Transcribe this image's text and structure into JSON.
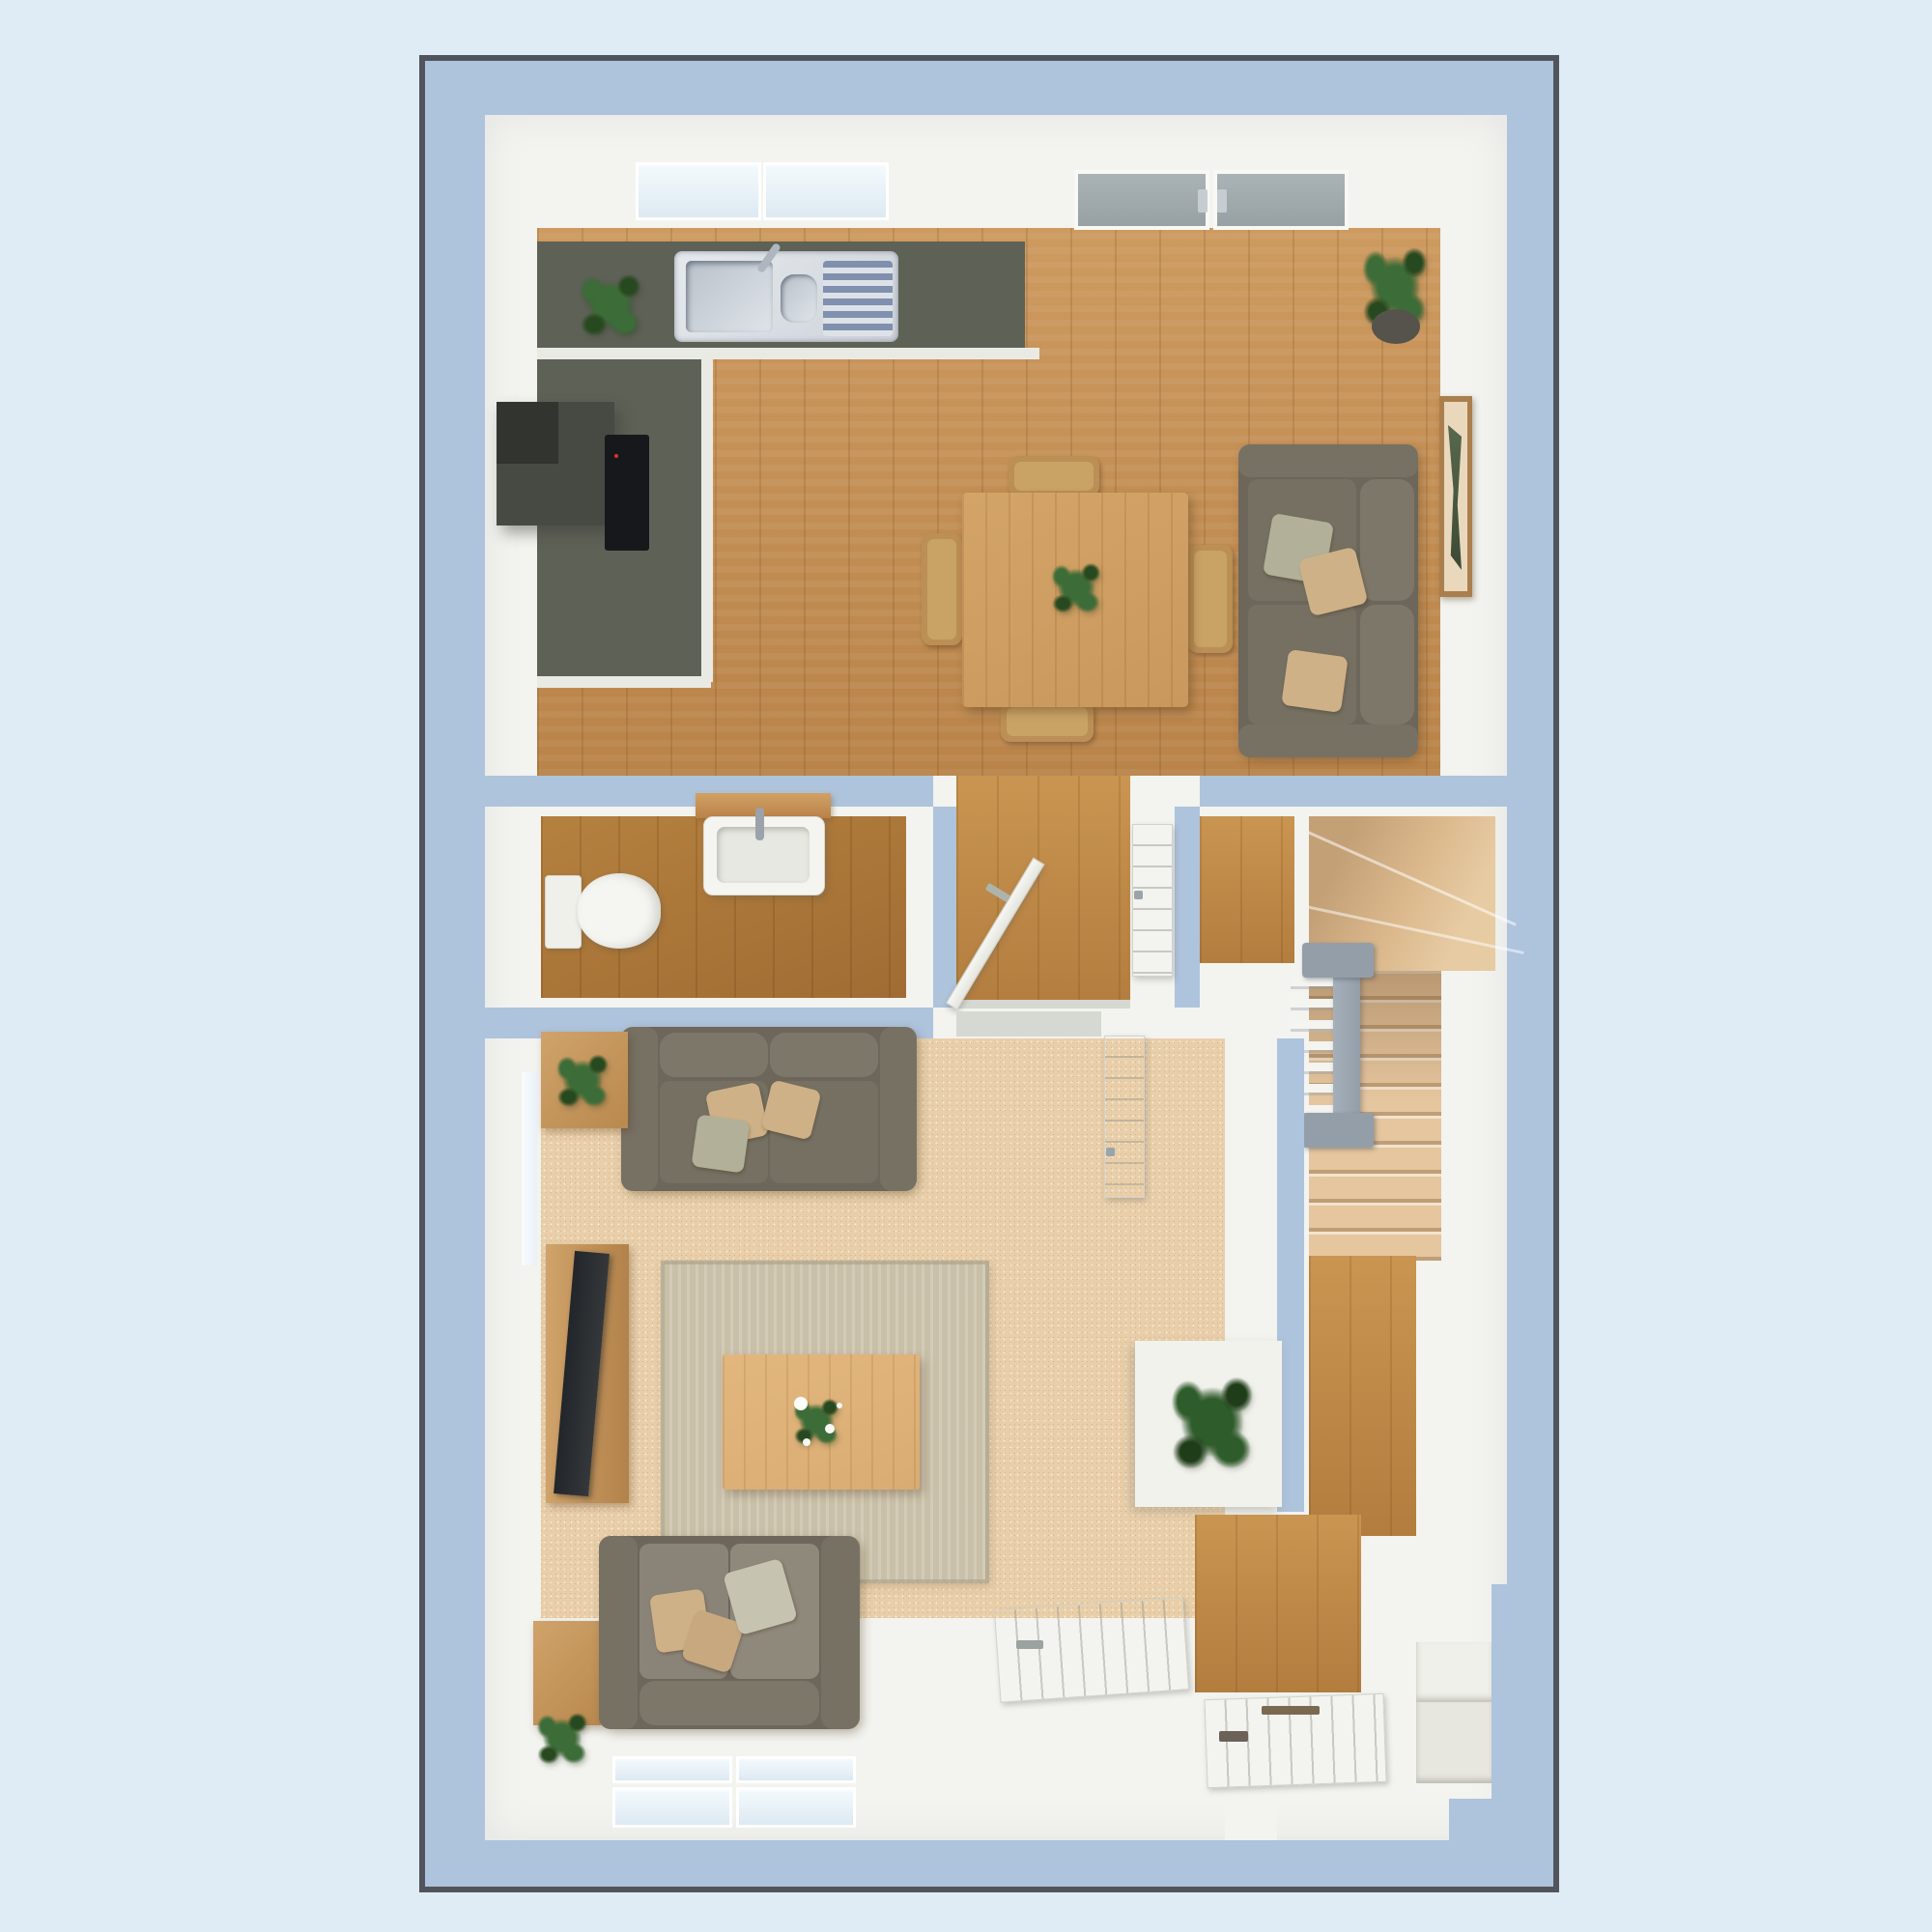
{
  "scene": {
    "kind": "3d-rendered-floor-plan",
    "view": "top-down dollhouse view, single storey",
    "no_visible_text": true
  },
  "palette": {
    "bg": "#dfecf5",
    "frame_border": "#51555b",
    "wall": "#aec3dc",
    "interior": "#f3f3ef",
    "counter": "#5e6156",
    "counter_edge": "#eaeae4",
    "steel": "#ced3d9",
    "drainer_stripe": "#8090ae",
    "hob": "#17181b",
    "hood": "#474a43",
    "sofa": "#6c665b",
    "sofa_arm": "#777164",
    "sofa_seat": "#757062",
    "sofa_back": "#7d776a",
    "pillow_tan": "#cfb187",
    "pillow_sage": "#b2b098",
    "table_wood": "#c9985c",
    "chair_wood": "#bb8f55",
    "carpet": "#e9cfa9",
    "stairs_carpet": "#e5c69e",
    "rug": "#c9c0a9",
    "coffee": "#d9ac73",
    "tvunit": "#c49960",
    "tv": "#34383b",
    "rail": "#949ea8",
    "door": "#f1f2ed",
    "plant": "#3c6d38",
    "plant_dark": "#27491f",
    "pframe": "#aa7f4d",
    "pmat": "#ead8bd",
    "part": "#57684c",
    "glass": "#dde9f2",
    "glass_gray": "#97a1a4",
    "threshold": "#d6d8d2"
  },
  "rooms": {
    "kitchen_dining": {
      "name": "kitchen-dining-room",
      "floor": "oak wood",
      "items": [
        "l-shaped-counter",
        "double-sink-with-drainer",
        "tap",
        "counter-plant",
        "extractor-hood",
        "induction-hob",
        "kitchen-window",
        "french-doors",
        "dining-table",
        "table-centre-plant",
        "dining-chairs",
        "two-seat-sofa",
        "scatter-pillows",
        "wall-art",
        "corner-potted-fern"
      ],
      "dining_chair_count": 4
    },
    "wc": {
      "name": "cloakroom-wc",
      "floor": "oak wood",
      "items": [
        "toilet",
        "wash-basin",
        "basin-shelf",
        "tap"
      ]
    },
    "hallway_passage": {
      "name": "inner-hallway",
      "floor": "oak wood",
      "items": [
        "open-door",
        "wall-radiator",
        "threshold"
      ]
    },
    "stair_hall": {
      "name": "staircase-hall",
      "floor": "carpet stairs over wood landing",
      "items": [
        "winder-treads",
        "straight-flight",
        "balustrade",
        "newel-posts",
        "spindles"
      ]
    },
    "living_room": {
      "name": "living-room",
      "floor": "beige carpet",
      "items": [
        "sofa-top",
        "sofa-bottom",
        "scatter-pillows",
        "area-rug",
        "coffee-table",
        "flower-centrepiece",
        "tv-unit",
        "tv",
        "side-table-with-plant",
        "corner-side-table",
        "floor-plant",
        "open-door-to-hall",
        "open-door-to-passage",
        "under-stair-shelf-plant",
        "bay-window"
      ]
    },
    "entrance_hall": {
      "name": "entrance-hall",
      "floor": "oak wood",
      "items": [
        "front-door",
        "door-handle",
        "letterbox",
        "entrance-steps",
        "hall-plant"
      ]
    }
  }
}
